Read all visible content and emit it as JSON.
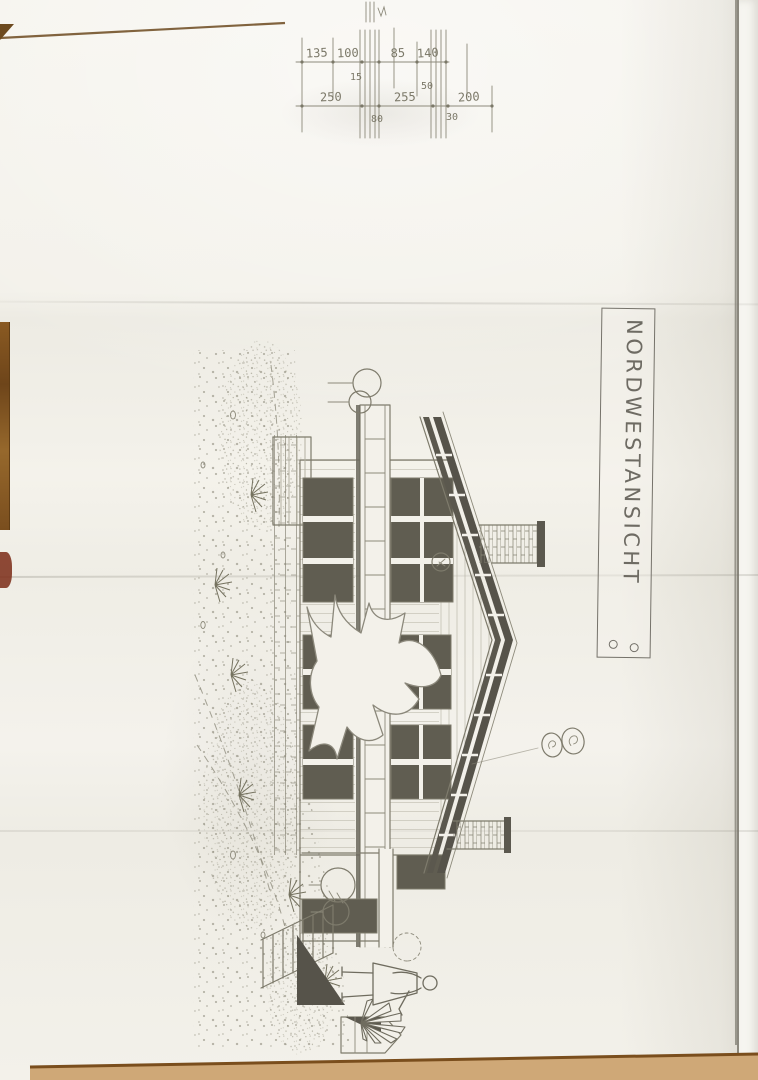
{
  "title_block": {
    "label": "NORDWESTANSICHT"
  },
  "dimensions": {
    "row1": [
      "135",
      "100",
      "85",
      "140"
    ],
    "row1_sub": "15",
    "row1_side": "50",
    "row2": [
      "250",
      "255",
      "200"
    ],
    "row2_sub": [
      "80",
      "30"
    ]
  },
  "palette": {
    "table_wood": "#a9814e",
    "paper": "#f3f1ea",
    "pencil_line": "#7e7b6c",
    "dark_fill": "#56534a",
    "table_edge": "#7a4e1d"
  }
}
